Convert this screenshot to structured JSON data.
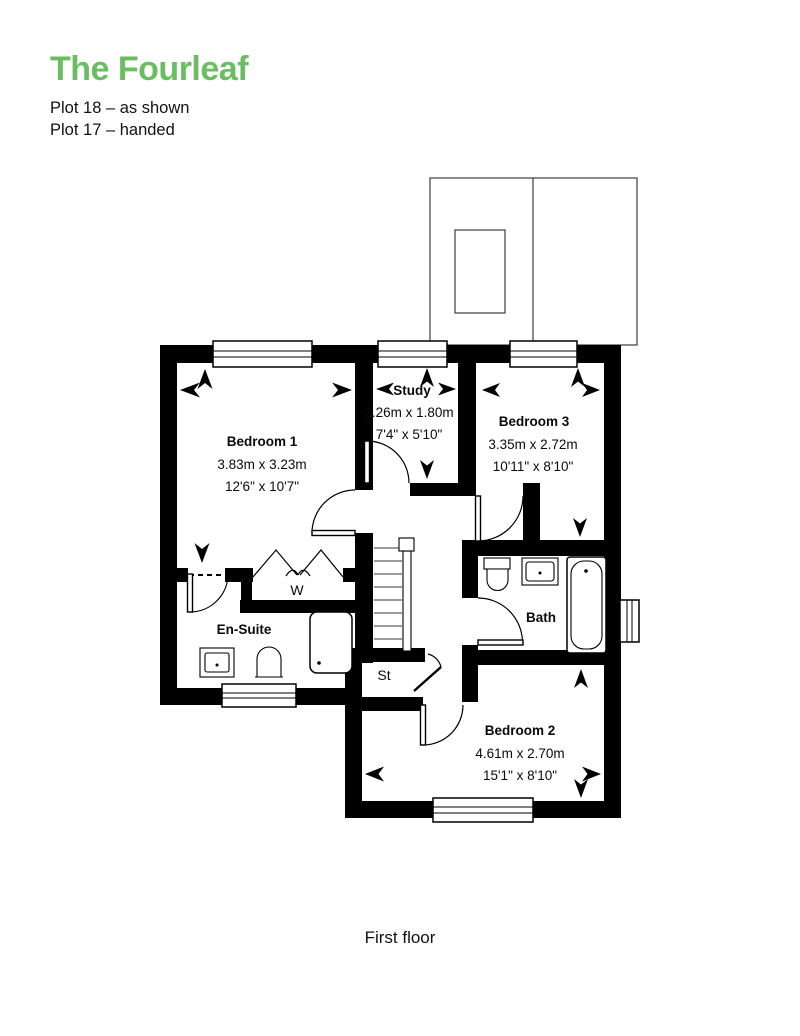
{
  "header": {
    "title": "The Fourleaf",
    "plot_line_1": "Plot 18 – as shown",
    "plot_line_2": "Plot 17 – handed"
  },
  "colors": {
    "title_green": "#6abe61",
    "wall_black": "#000000"
  },
  "floor_plan": {
    "rooms": {
      "bedroom1": {
        "name": "Bedroom 1",
        "metric": "3.83m x 3.23m",
        "imperial": "12'6\" x 10'7\""
      },
      "study": {
        "name": "Study",
        "metric": "2.26m x 1.80m",
        "imperial": "7'4\" x 5'10\""
      },
      "bedroom3": {
        "name": "Bedroom 3",
        "metric": "3.35m x 2.72m",
        "imperial": "10'11\" x 8'10\""
      },
      "bedroom2": {
        "name": "Bedroom 2",
        "metric": "4.61m x 2.70m",
        "imperial": "15'1\" x 8'10\""
      },
      "ensuite": {
        "name": "En-Suite"
      },
      "bath": {
        "name": "Bath"
      },
      "wardrobe": {
        "name": "W"
      },
      "store": {
        "name": "St"
      }
    },
    "caption": "First floor"
  }
}
